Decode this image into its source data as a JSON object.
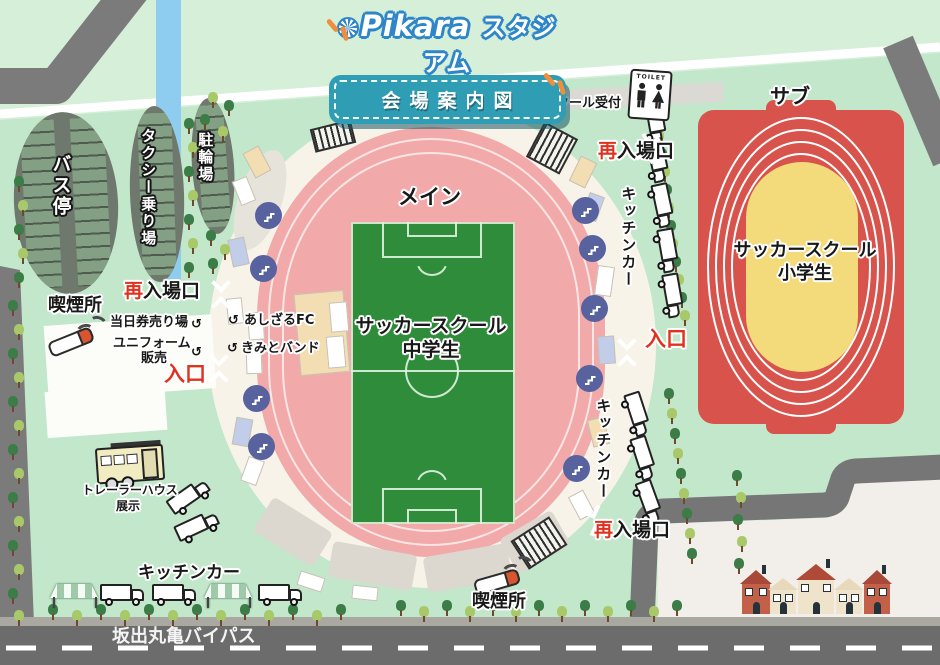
{
  "title": {
    "logo_main": "Pikara",
    "logo_sub": "スタジアム",
    "banner": "会場案内図"
  },
  "areas": {
    "bus_stop": "バス停",
    "taxi_stand": "タクシー乗り場",
    "bicycle_parking": "駐輪場",
    "smoking_area": "喫煙所",
    "main_track": "メイン",
    "main_field_line1": "サッカースクール",
    "main_field_line2": "中学生",
    "sub_track": "サブ",
    "sub_field_line1": "サッカースクール",
    "sub_field_line2": "小学生",
    "kitchen_car": "キッチンカー",
    "trailer_line1": "トレーラーハウス",
    "trailer_line2": "展示"
  },
  "gates": {
    "reentry_first": "再",
    "reentry_rest": "入場口",
    "entrance": "入口"
  },
  "facilities": {
    "school_reception": "スクール受付",
    "toilet": "TOILET",
    "day_ticket": "当日券売り場",
    "uniform_line1": "ユニフォーム",
    "uniform_line2": "販売",
    "booth_1": "あしざるFC",
    "booth_2": "きみとバンド"
  },
  "road": {
    "name": "坂出丸亀バイパス"
  },
  "icons": {
    "booth_arrow": "↺",
    "reception_arrow": "↺"
  },
  "colors": {
    "track_pink": "#f1a9a9",
    "field_green": "#2f8c3a",
    "sub_red": "#d7534b",
    "sub_infield_yellow": "#f3da7a",
    "accent_red": "#e0321f",
    "title_teal": "#2f9db4",
    "logo_blue": "#2e86c8",
    "orange_accent": "#ef8f3c",
    "venue_green": "#c2e7cb",
    "road_gray": "#6c6c6c",
    "river_blue": "#8fcdf0"
  }
}
